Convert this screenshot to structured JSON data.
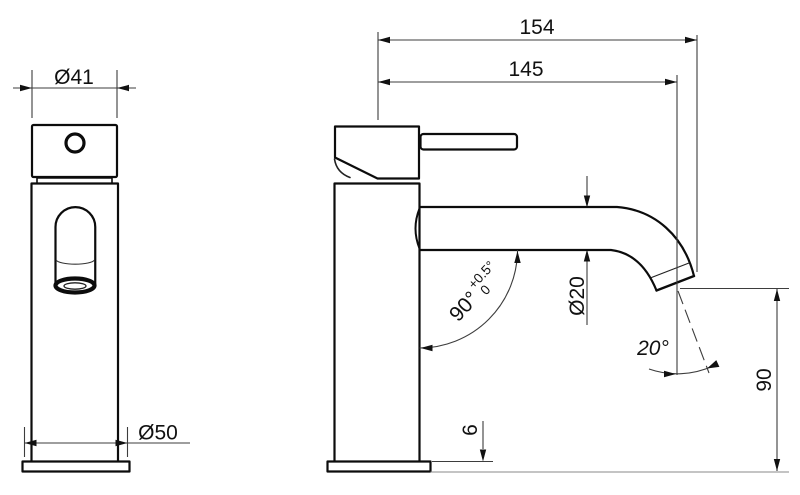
{
  "labels": {
    "front": {
      "top_diameter": "Ø41",
      "base_diameter": "Ø50"
    },
    "side": {
      "reach_total": "154",
      "reach_to_aerator": "145",
      "spout_diameter": "Ø20",
      "spout_angle": "90°",
      "spout_angle_tol_upper": "+0.5°",
      "spout_angle_tol_lower": "0",
      "aerator_angle": "20°",
      "spout_height": "90",
      "base_plate_thickness": "6"
    }
  },
  "colors": {
    "outline": "#0c0c0c",
    "dimension_line": "#3d3d3d",
    "ground_line": "#888888",
    "background": "#ffffff"
  }
}
